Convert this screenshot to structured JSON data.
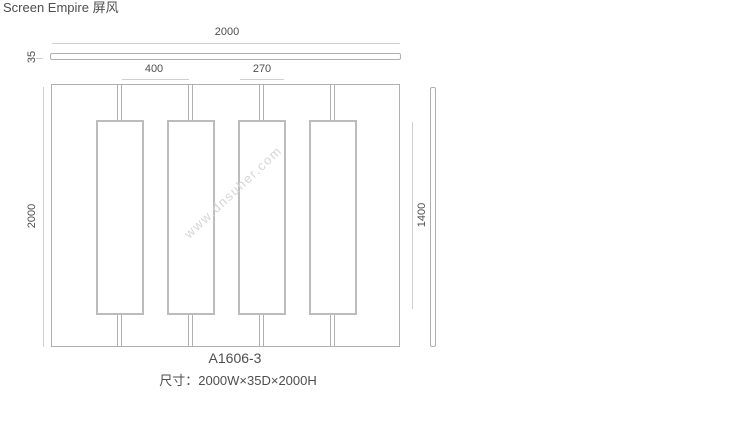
{
  "page": {
    "title": "Screen Empire 屏风"
  },
  "drawing": {
    "model": "A1606-3",
    "size_caption": "尺寸：2000W×35D×2000H",
    "panel_count": 4,
    "dimensions": {
      "overall_width": "2000",
      "depth": "35",
      "panel_spacing": "400",
      "panel_width": "270",
      "overall_height": "2000",
      "panel_height": "1400"
    }
  },
  "watermark": {
    "text": "www.dnsuher.com"
  },
  "colors": {
    "background": "#ffffff",
    "line": "#b0b0b0",
    "panel_border": "#bcbcbc",
    "dim_line": "#cfcfcf",
    "text": "#4e4e4e",
    "watermark": "#d6d6d6"
  }
}
